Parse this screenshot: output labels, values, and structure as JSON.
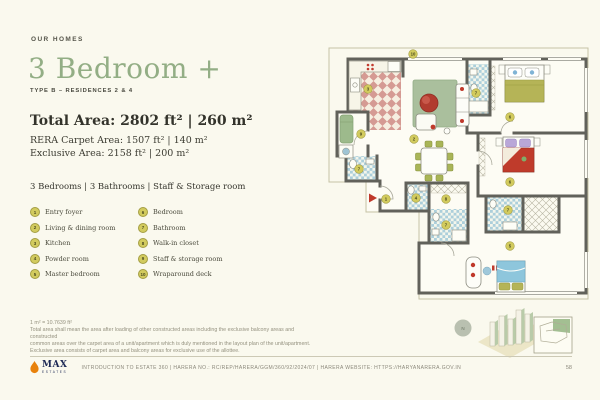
{
  "header": {
    "eyebrow": "OUR HOMES"
  },
  "title": {
    "text": "3 Bedroom +",
    "subtitle": "TYPE B – RESIDENCES 2 & 4",
    "accent_color": "#93AE85"
  },
  "areas": {
    "total": "Total Area: 2802 ft² | 260 m²",
    "rera": "RERA Carpet Area: 1507 ft²  |  140 m²",
    "exclusive": "Exclusive Area: 2158 ft²  |  200 m²"
  },
  "configuration": "3 Bedrooms  |  3 Bathrooms  |  Staff & Storage room",
  "legend": {
    "items": [
      {
        "num": "1",
        "label": "Entry foyer"
      },
      {
        "num": "2",
        "label": "Living & dining room"
      },
      {
        "num": "3",
        "label": "Kitchen"
      },
      {
        "num": "4",
        "label": "Powder room"
      },
      {
        "num": "5",
        "label": "Master bedroom"
      },
      {
        "num": "6",
        "label": "Bedroom"
      },
      {
        "num": "7",
        "label": "Bathroom"
      },
      {
        "num": "8",
        "label": "Walk-in closet"
      },
      {
        "num": "9",
        "label": "Staff & storage room"
      },
      {
        "num": "10",
        "label": "Wraparound deck"
      }
    ],
    "marker_fill": "#D2CB5E",
    "marker_border": "#A49E43"
  },
  "disclaimer": {
    "lines": [
      "1 m² = 10.7639 ft²",
      "Total area shall mean the area after loading of other constructed areas including the exclusive balcony areas and constructed",
      "common areas over the carpet area of a unit/apartment which is duly mentioned in the layout plan of the unit/apartment.",
      "Exclusive area consists of carpet area and balcony areas for exclusive use of the allottee."
    ]
  },
  "footer": {
    "brand": {
      "name": "MAX",
      "sub": "ESTATES"
    },
    "text": "INTRODUCTION TO ESTATE 360  |  HARERA no.: RC/REP/HARERA/GGM/360/92/2024/07  |  HARERA website: https://haryanarera.gov.in",
    "page": "58"
  },
  "floorplan": {
    "colors": {
      "wall": "#61615A",
      "kitchen_tile": "#D59A93",
      "bath_tile": "#ACCFDB",
      "rug": "#AABF9D",
      "sofa_red": "#B13C2F",
      "duvet_olive": "#B5B457",
      "duvet_red": "#BF3B2B",
      "duvet_blue": "#8EC6DC",
      "chair_olive": "#A9B557"
    },
    "north_label": "N",
    "markers": [
      {
        "n": "10",
        "x": 413,
        "y": 54
      },
      {
        "n": "3",
        "x": 368,
        "y": 89
      },
      {
        "n": "7",
        "x": 476,
        "y": 93
      },
      {
        "n": "6",
        "x": 510,
        "y": 117
      },
      {
        "n": "9",
        "x": 361,
        "y": 134
      },
      {
        "n": "2",
        "x": 414,
        "y": 139
      },
      {
        "n": "7",
        "x": 359,
        "y": 169
      },
      {
        "n": "6",
        "x": 510,
        "y": 182
      },
      {
        "n": "1",
        "x": 386,
        "y": 199
      },
      {
        "n": "4",
        "x": 416,
        "y": 198
      },
      {
        "n": "8",
        "x": 446,
        "y": 199
      },
      {
        "n": "7",
        "x": 508,
        "y": 210
      },
      {
        "n": "7",
        "x": 446,
        "y": 225
      },
      {
        "n": "5",
        "x": 510,
        "y": 246
      }
    ]
  }
}
